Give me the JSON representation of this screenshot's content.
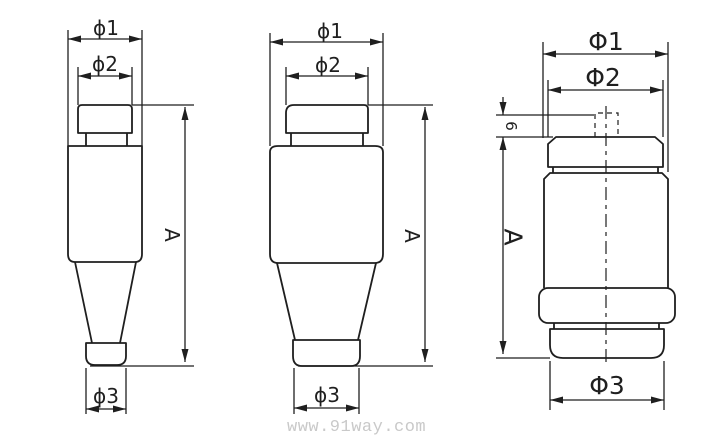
{
  "page": {
    "background": "#ffffff",
    "line_color": "#1f1f1f",
    "text_color": "#1f1f1f"
  },
  "watermark": {
    "text": "www.91way.com",
    "color": "#c9c9c9"
  },
  "figures": [
    {
      "name": "fuse-outline-type-1",
      "labels": {
        "d1": "ϕ1",
        "d2": "ϕ2",
        "d3": "ϕ3",
        "height": "A"
      }
    },
    {
      "name": "fuse-outline-type-2",
      "labels": {
        "d1": "ϕ1",
        "d2": "ϕ2",
        "d3": "ϕ3",
        "height": "A"
      }
    },
    {
      "name": "fuse-outline-type-3",
      "labels": {
        "d1": "Φ1",
        "d2": "Φ2",
        "d3": "Φ3",
        "height": "A",
        "tip": "6"
      }
    }
  ]
}
